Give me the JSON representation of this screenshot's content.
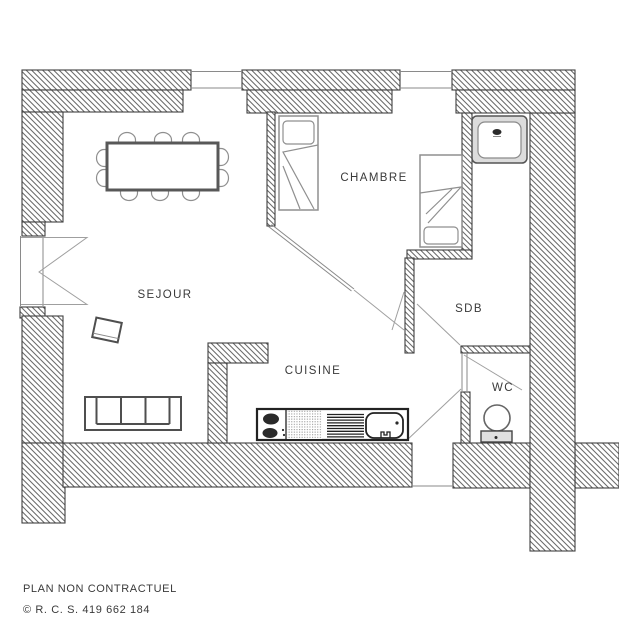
{
  "plan": {
    "title": "apartment-floor-plan",
    "rooms": [
      {
        "id": "sejour",
        "label": "SEJOUR"
      },
      {
        "id": "chambre",
        "label": "CHAMBRE"
      },
      {
        "id": "cuisine",
        "label": "CUISINE"
      },
      {
        "id": "sdb",
        "label": "SDB"
      },
      {
        "id": "wc",
        "label": "WC"
      }
    ],
    "fixtures": [
      "dining-table",
      "dining-chair",
      "accent-chair",
      "sofa",
      "single-bed",
      "washbasin",
      "kitchen-counter",
      "stove-burners",
      "kitchen-sink",
      "toilet",
      "french-window",
      "window",
      "door-swing"
    ]
  },
  "footer": {
    "disclaimer": "PLAN NON CONTRACTUEL",
    "registration": "© R. C. S. 419 662 184"
  },
  "colors": {
    "wall_hatch": "#6b6b6b",
    "wall_outline": "#3f3f3f",
    "door_line": "#9f9f9f",
    "furniture_light": "#8f8f8f",
    "furniture_dark": "#4f4f4f",
    "counter_dark": "#222222",
    "text_color": "#3a3a3a"
  }
}
